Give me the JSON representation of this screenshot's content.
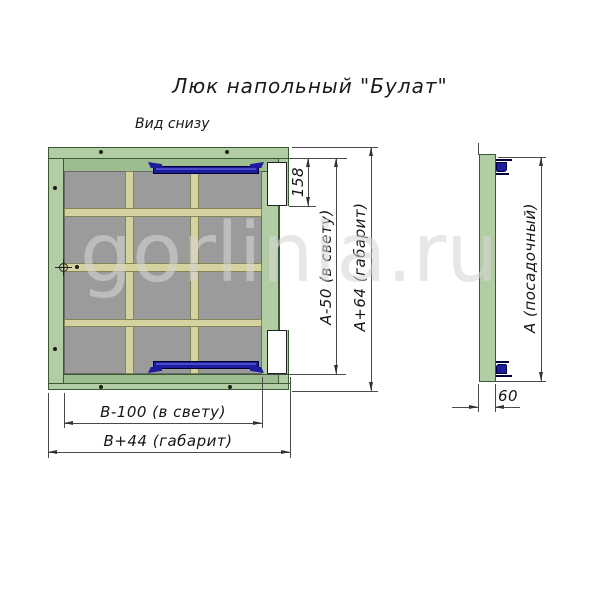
{
  "title": "Люк напольный \"Булат\"",
  "view_label": "Вид снизу",
  "watermark": "gorlinia.ru",
  "dimensions": {
    "hinge_offset": "158",
    "height_clear": "А-50 (в свету)",
    "height_overall": "А+64 (габарит)",
    "width_clear": "В-100 (в свету)",
    "width_overall": "В+44 (габарит)",
    "side_height": "А (посадочный)",
    "side_thickness": "60"
  },
  "colors": {
    "frame_green": "#b2cda4",
    "lid_green": "#9dbc8f",
    "outline_green": "#3a5a36",
    "panel_gray": "#9b9b9b",
    "rib_tan": "#d6d2a0",
    "handle_blue": "#1c1c9c"
  }
}
